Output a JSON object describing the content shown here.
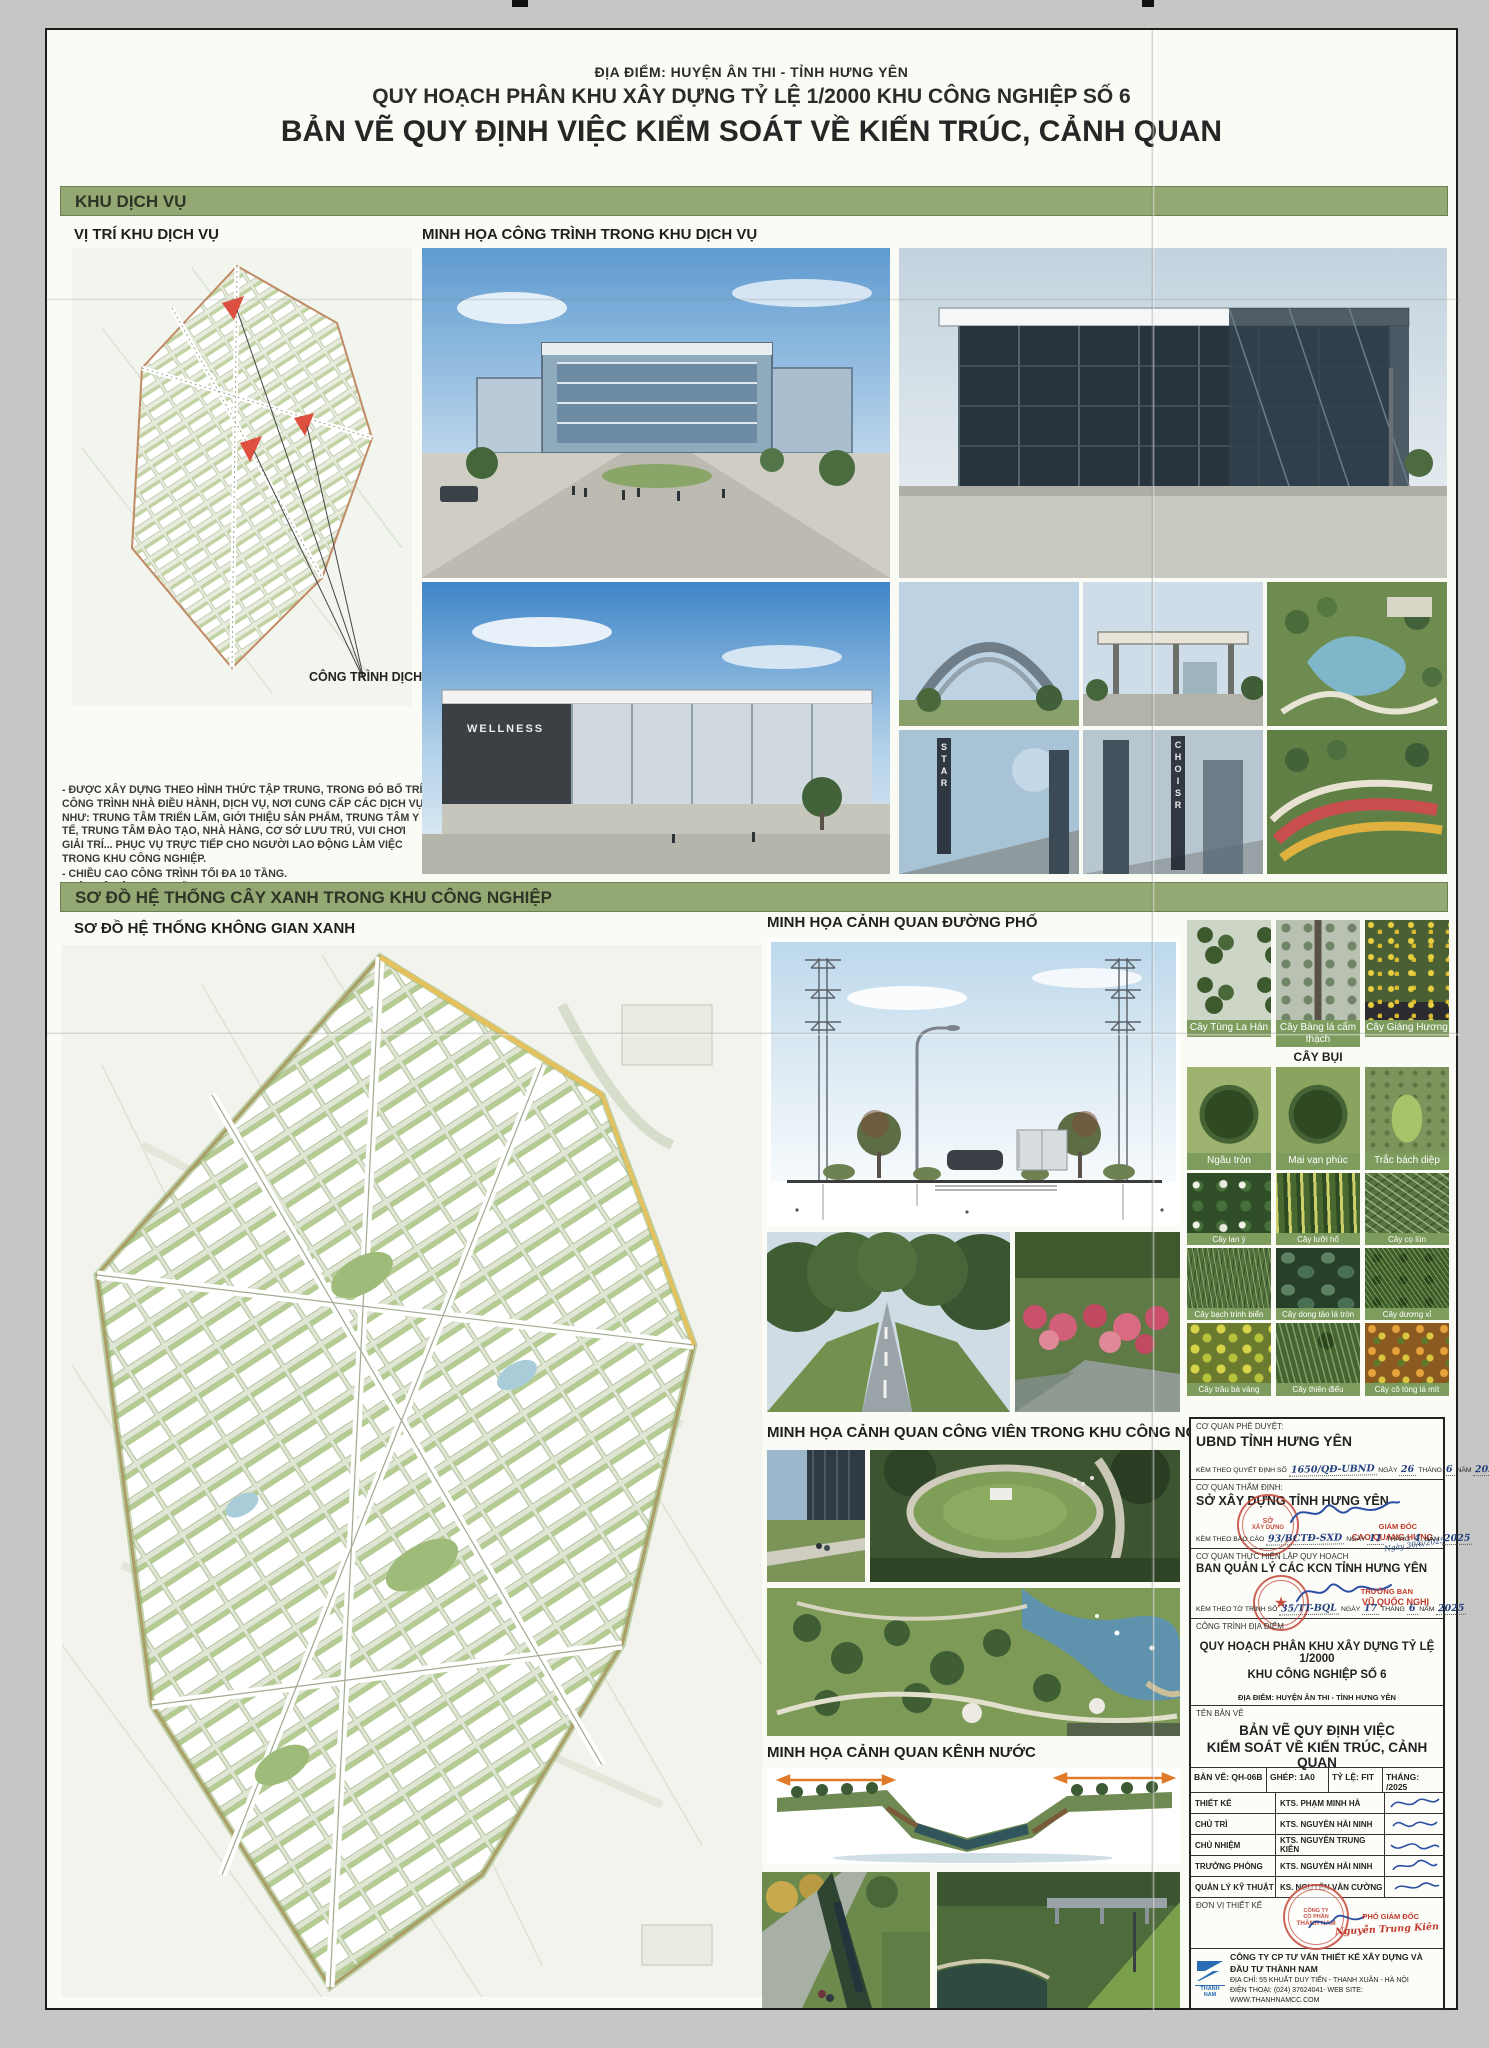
{
  "header": {
    "location": "ĐỊA ĐIỂM: HUYỆN ÂN THI - TỈNH HƯNG YÊN",
    "plan": "QUY HOẠCH PHÂN KHU XÂY DỰNG TỶ LỆ 1/2000 KHU CÔNG NGHIỆP SỐ 6",
    "title": "BẢN VẼ QUY ĐỊNH VIỆC KIỂM SOÁT VỀ KIẾN TRÚC, CẢNH QUAN"
  },
  "service_section": {
    "band": "KHU DỊCH VỤ",
    "map_label": "VỊ TRÍ KHU DỊCH VỤ",
    "illus_label": "MINH HỌA CÔNG TRÌNH TRONG KHU DỊCH VỤ",
    "callout": "CÔNG TRÌNH DỊCH VỤ",
    "notes": [
      "-      ĐƯỢC XÂY DỰNG THEO HÌNH THỨC TẬP TRUNG, TRONG ĐÓ BỐ TRÍ CÔNG TRÌNH NHÀ ĐIỀU HÀNH, DỊCH VỤ, NƠI CUNG CẤP CÁC DỊCH VỤ NHƯ: TRUNG TÂM TRIỂN LÃM, GIỚI THIỆU SẢN PHẨM, TRUNG TÂM Y TẾ, TRUNG TÂM ĐÀO TẠO, NHÀ HÀNG, CƠ SỞ LƯU TRÚ, VUI CHƠI GIẢI TRÍ... PHỤC VỤ TRỰC TIẾP CHO NGƯỜI LAO ĐỘNG LÀM VIỆC TRONG KHU CÔNG NGHIỆP.",
      "-      CHIỀU CAO CÔNG TRÌNH TỐI ĐA 10 TẦNG.",
      "-      MẬT ĐỘ XÂY DỰNG TỐI ĐA 40%."
    ],
    "sign_star": "STAR",
    "sign_choisr": "CHOISR",
    "wellness": "WELLNESS"
  },
  "green_section": {
    "band": "SƠ ĐỒ HỆ THỐNG CÂY XANH TRONG KHU CÔNG NGHIỆP",
    "plan_label": "SƠ ĐỒ HỆ THỐNG KHÔNG GIAN XANH",
    "street_label": "MINH HỌA CẢNH QUAN ĐƯỜNG PHỐ",
    "park_label": "MINH HỌA CẢNH QUAN CÔNG VIÊN TRONG KHU CÔNG NGHIỆP",
    "canal_label": "MINH HỌA CẢNH QUAN KÊNH NƯỚC"
  },
  "plants": {
    "shrub_header": "CÂY BỤI",
    "row1": [
      "Cây Tùng La Hán",
      "Cây Bàng lá cẩm thạch",
      "Cây Giáng Hương"
    ],
    "row2": [
      "Ngâu tròn",
      "Mai vạn phúc",
      "Trắc bách diệp"
    ],
    "row3": [
      "Cây lan ý",
      "Cây lưỡi hổ",
      "Cây cọ lùn"
    ],
    "row4": [
      "Cây bạch trinh biển",
      "Cây dong tào lá tròn",
      "Cây dương xỉ"
    ],
    "row5": [
      "Cây trầu bà vàng",
      "Cây thiên điểu",
      "Cây cô tòng lá mít"
    ]
  },
  "titleblock": {
    "approve_label": "CƠ QUAN PHÊ DUYỆT:",
    "approve_name": "UBND TỈNH HƯNG YÊN",
    "decision": {
      "prefix": "KÈM THEO QUYẾT ĐỊNH SỐ",
      "no": "1650/QĐ-UBND",
      "ngay": "NGÀY",
      "day": "26",
      "thang": "THÁNG",
      "month": "6",
      "nam": "NĂM",
      "year": "2025"
    },
    "appraise_label": "CƠ QUAN THẨM ĐỊNH:",
    "appraise_name": "SỞ XÂY DỰNG TỈNH HƯNG YÊN",
    "report": {
      "prefix": "KÈM THEO BÁO CÁO",
      "no": "93/BCTĐ-SXD",
      "ngay": "NGÀY",
      "day": "11",
      "thang": "THÁNG",
      "month": "4",
      "nam": "NĂM",
      "year": "2025"
    },
    "director_title": "GIÁM ĐỐC",
    "director_name": "CAO QUANG HƯNG",
    "date_note": "Ngày 30/6/2025",
    "stamp_sxd_top": "SỞ",
    "stamp_sxd_bottom": "XÂY DỰNG",
    "maker_label": "CƠ QUAN THỰC HIỆN LẬP QUY HOẠCH",
    "maker_name": "BAN QUẢN LÝ CÁC KCN TỈNH HƯNG YÊN",
    "head_title": "TRƯỞNG BAN",
    "head_name": "VŨ QUỐC NGHỊ",
    "submission": {
      "prefix": "KÈM THEO TỜ TRÌNH SỐ",
      "no": "35/TT-BQL",
      "ngay": "NGÀY",
      "day": "17",
      "thang": "THÁNG",
      "month": "6",
      "nam": "NĂM",
      "year": "2025"
    },
    "project_label": "CÔNG TRÌNH ĐỊA ĐIỂM",
    "project_line1": "QUY HOẠCH PHÂN KHU XÂY DỰNG TỶ LỆ 1/2000",
    "project_line2": "KHU CÔNG NGHIỆP SỐ 6",
    "project_loc": "ĐỊA ĐIỂM: HUYỆN ÂN THI - TỈNH  HƯNG YÊN",
    "name_label": "TÊN BẢN VẼ",
    "name_line1": "BẢN VẼ QUY ĐỊNH VIỆC",
    "name_line2": "KIỂM SOÁT VỀ KIẾN TRÚC, CẢNH QUAN",
    "meta": [
      {
        "k": "BẢN VẼ:",
        "v": "QH-06B"
      },
      {
        "k": "GHÉP:",
        "v": "1A0"
      },
      {
        "k": "TỶ LỆ:",
        "v": "FIT"
      },
      {
        "k": "THÁNG:",
        "v": "/2025"
      }
    ],
    "staff": [
      {
        "role": "THIẾT KẾ",
        "name": "KTS. PHẠM MINH HÀ"
      },
      {
        "role": "CHỦ TRÌ",
        "name": "KTS. NGUYỄN HẢI NINH"
      },
      {
        "role": "CHỦ NHIỆM",
        "name": "KTS. NGUYỄN TRUNG KIÊN"
      },
      {
        "role": "TRƯỞNG PHÒNG",
        "name": "KTS. NGUYỄN HẢI NINH"
      },
      {
        "role": "QUẢN LÝ KỸ THUẬT",
        "name": "KS. NGUYỄN VĂN CƯỜNG"
      }
    ],
    "unit_label": "ĐƠN VỊ THIẾT KẾ",
    "deputy_title": "PHÓ GIÁM ĐỐC",
    "deputy_name": "Nguyễn Trung Kiên",
    "company_stamp_line1": "CÔNG TY",
    "company_stamp_line2": "CỔ PHẦN",
    "company_stamp_line3": "THÀNH NAM",
    "company": {
      "logo_text": "THANH NAM",
      "name": "CÔNG TY CP TƯ VẤN THIẾT KẾ XÂY DỰNG VÀ ĐẦU TƯ THÀNH NAM",
      "address": "ĐỊA CHỈ: 55 KHUẤT DUY TIẾN - THANH XUÂN - HÀ NỘI",
      "phone": "ĐIỆN THOẠI: (024) 37624041- WEB SITE: WWW.THANHNAMCC.COM"
    }
  },
  "colors": {
    "band_green": "#93a873",
    "caption_green": "#7d9c5e",
    "stamp_red": "#c0392b",
    "ink_blue": "#24407e"
  }
}
